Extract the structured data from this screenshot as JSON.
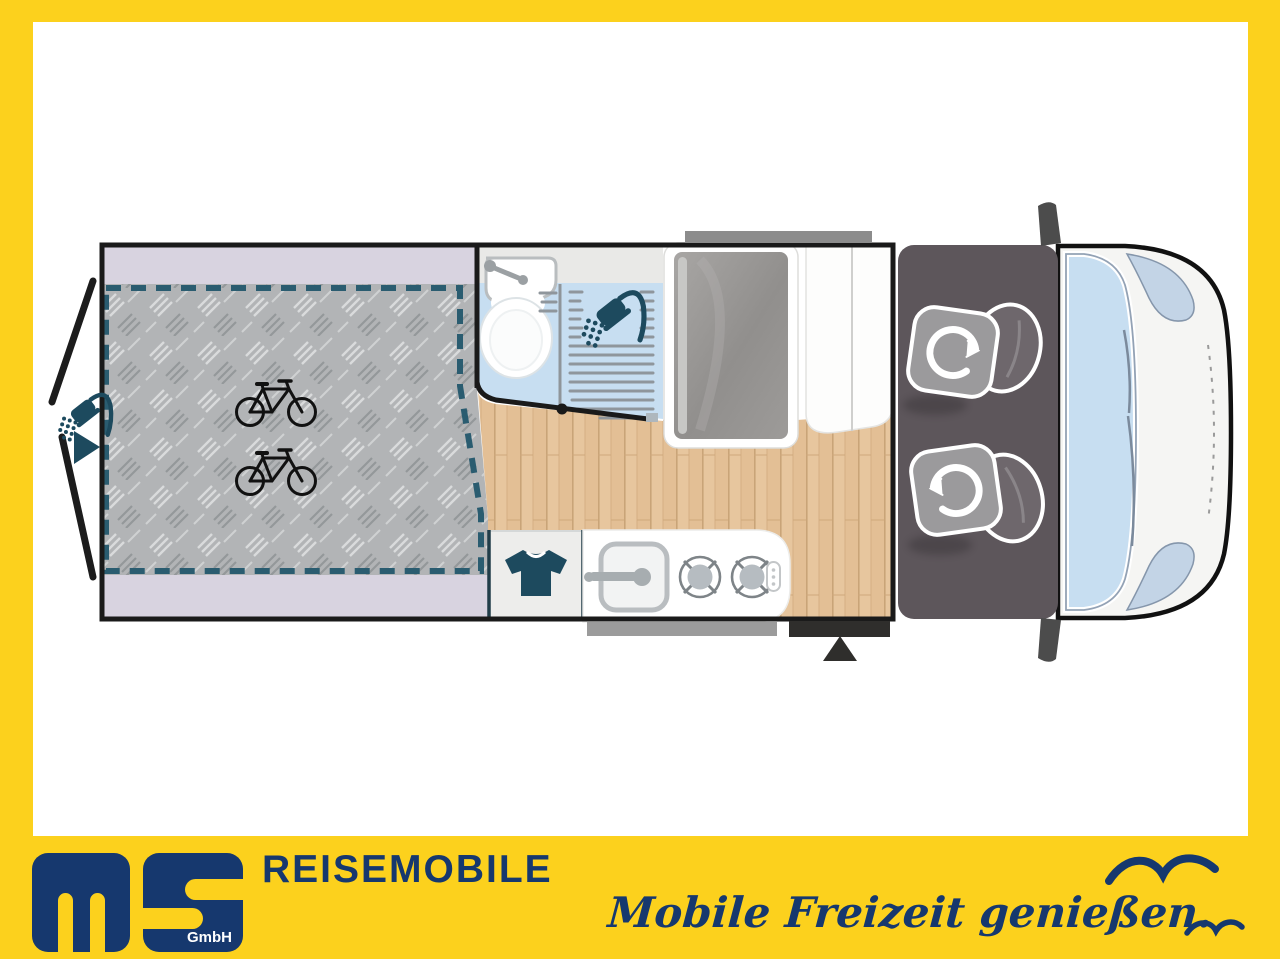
{
  "brand": {
    "logo_letters": "ms",
    "logo_suffix": "GmbH",
    "company": "REISEMOBILE",
    "tagline": "Mobile Freizeit genießen."
  },
  "colors": {
    "frame_yellow": "#FCD11D",
    "brand_navy": "#16386E",
    "icon_teal": "#1D4A5E",
    "dash_teal": "#2A5C70",
    "lavender": "#D8D3E0",
    "checker_gray": "#B2B4B6",
    "wood": "#E6C49C",
    "bath_blue": "#C7DEF1",
    "cab_gray": "#5D565B",
    "seat_base_gray": "#9B9A9C",
    "seat_back_gray": "#6E676C",
    "body_white": "#FFFFFF",
    "outline_black": "#1A1A1A"
  },
  "floorplan": {
    "type": "campervan top view layout drawing",
    "features": [
      {
        "id": "rear-garage",
        "label": "rear storage / bed area with checker-plate floor and dashed bed outline"
      },
      {
        "id": "bicycle-storage",
        "label": "space for two bicycles"
      },
      {
        "id": "rear-doors",
        "label": "rear doors shown open"
      },
      {
        "id": "outdoor-shower",
        "label": "outdoor shower at rear with arrow marker"
      },
      {
        "id": "bathroom",
        "label": "washroom with washbasin, toilet and shower"
      },
      {
        "id": "refrigerator",
        "label": "tall fridge unit"
      },
      {
        "id": "wardrobe",
        "label": "white wardrobe beside cab"
      },
      {
        "id": "tshirt-cabinet",
        "label": "clothes cupboard with t-shirt symbol"
      },
      {
        "id": "kitchen",
        "label": "kitchen block with sink and two-burner hob"
      },
      {
        "id": "entrance",
        "label": "sliding-door entrance with step and arrow marker"
      },
      {
        "id": "cab",
        "label": "driver cab with two swivel seats"
      },
      {
        "id": "windshield",
        "label": "windscreen and cab windows"
      }
    ],
    "icons": [
      "bicycle-icon",
      "bicycle-icon",
      "shower-icon",
      "shower-icon",
      "tshirt-icon",
      "swivel-arrow-icon",
      "swivel-arrow-icon",
      "entrance-triangle-icon",
      "rear-arrow-icon",
      "bird-icon",
      "bird-icon"
    ]
  }
}
